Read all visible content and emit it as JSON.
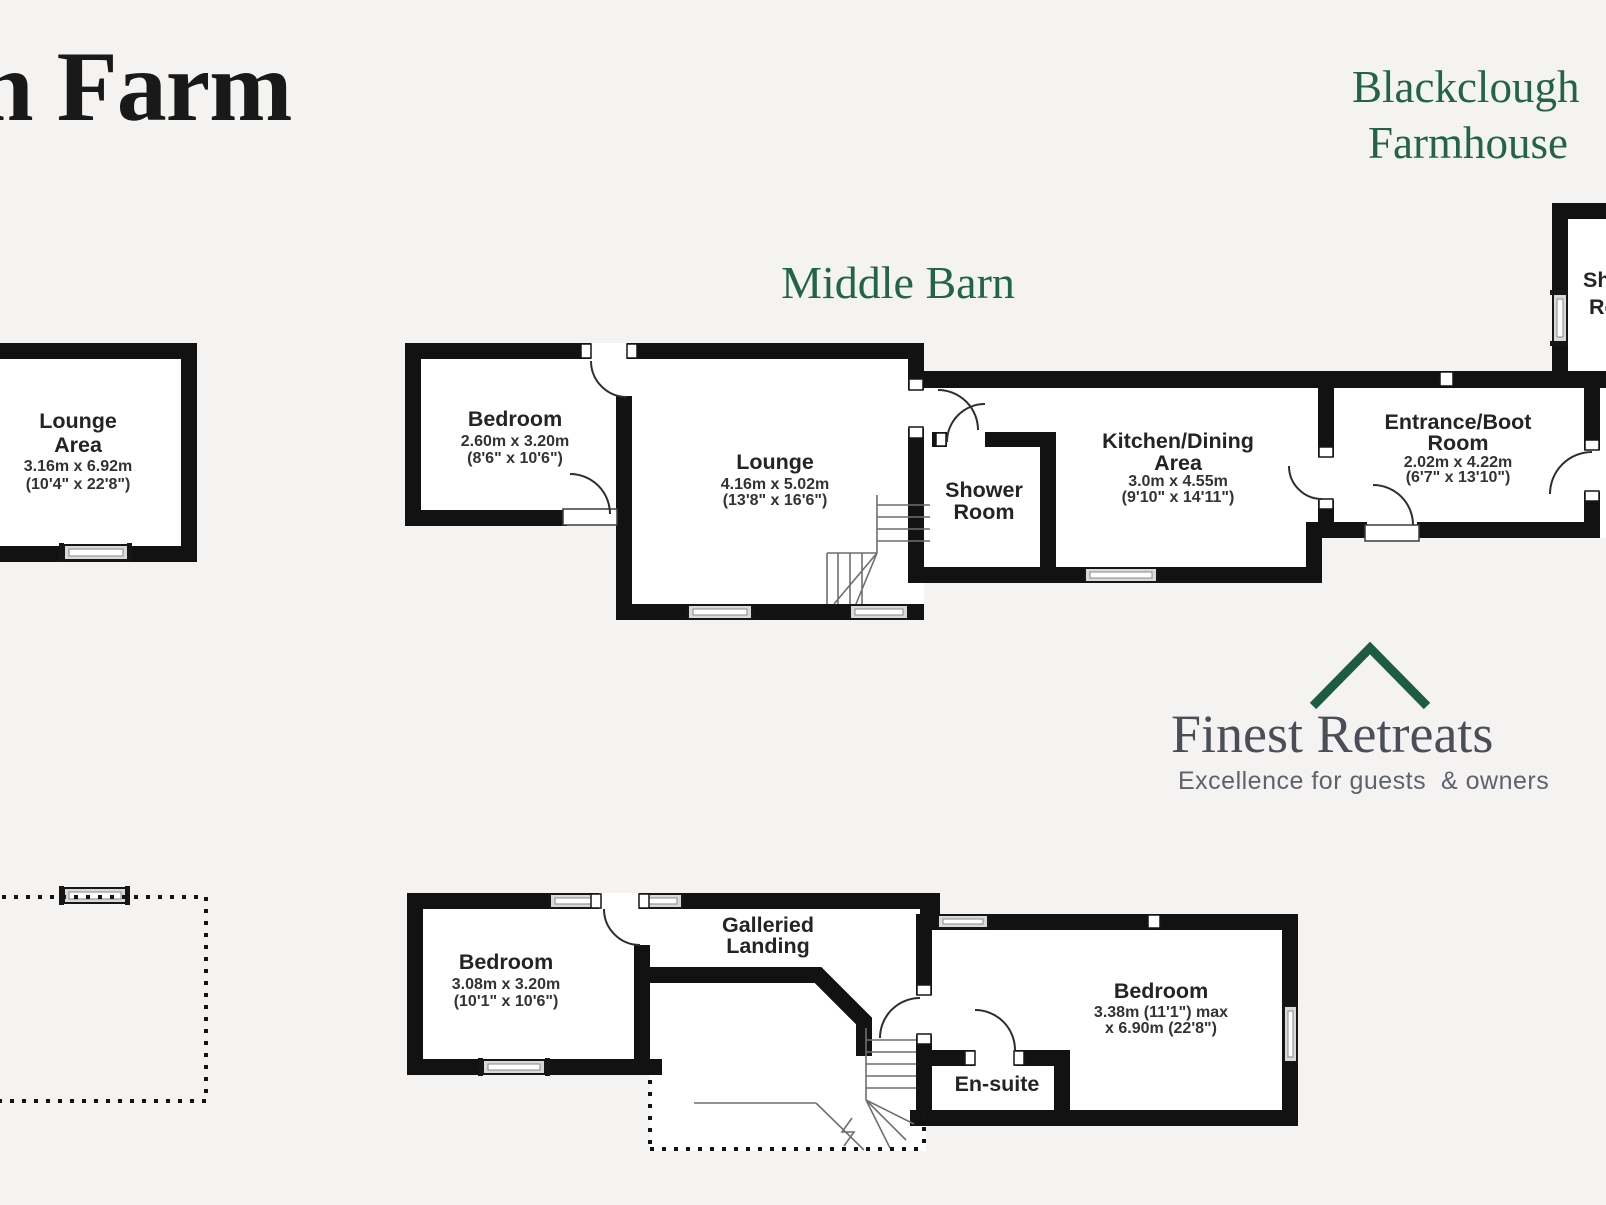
{
  "page": {
    "background": "#f4f3f1"
  },
  "header": {
    "farm_title": "n Farm",
    "title_color": "#236349",
    "farmhouse_title_line1": "Blackclough",
    "farmhouse_title_line2": "Farmhouse",
    "barn_title": "Middle Barn"
  },
  "branding": {
    "logo_text": "Finest Retreats",
    "tagline": "Excellence for guests  & owners",
    "accent_color": "#1e5b45",
    "logo_text_color": "#4a4e57"
  },
  "ground_floor": {
    "lounge_area": {
      "name_line1": "Lounge",
      "name_line2": "Area",
      "dims_metric": "3.16m x 6.92m",
      "dims_imperial": "(10'4\" x 22'8\")"
    },
    "bedroom": {
      "name": "Bedroom",
      "dims_metric": "2.60m x 3.20m",
      "dims_imperial": "(8'6\" x 10'6\")"
    },
    "lounge": {
      "name": "Lounge",
      "dims_metric": "4.16m x 5.02m",
      "dims_imperial": "(13'8\" x 16'6\")"
    },
    "shower_room": {
      "name_line1": "Shower",
      "name_line2": "Room"
    },
    "kitchen_dining": {
      "name_line1": "Kitchen/Dining",
      "name_line2": "Area",
      "dims_metric": "3.0m x 4.55m",
      "dims_imperial": "(9'10\" x 14'11\")"
    },
    "entrance_boot": {
      "name_line1": "Entrance/Boot",
      "name_line2": "Room",
      "dims_metric": "2.02m x 4.22m",
      "dims_imperial": "(6'7\" x 13'10\")"
    },
    "farmhouse_room": {
      "name_line1": "Shower",
      "name_line2": "Room"
    }
  },
  "first_floor": {
    "bedroom_left": {
      "name": "Bedroom",
      "dims_metric": "3.08m x 3.20m",
      "dims_imperial": "(10'1\" x 10'6\")"
    },
    "galleried_landing": {
      "name_line1": "Galleried",
      "name_line2": "Landing"
    },
    "bedroom_right": {
      "name": "Bedroom",
      "dims_line1": "3.38m (11'1\") max",
      "dims_line2": "x 6.90m (22'8\")"
    },
    "ensuite": {
      "name": "En-suite"
    }
  }
}
